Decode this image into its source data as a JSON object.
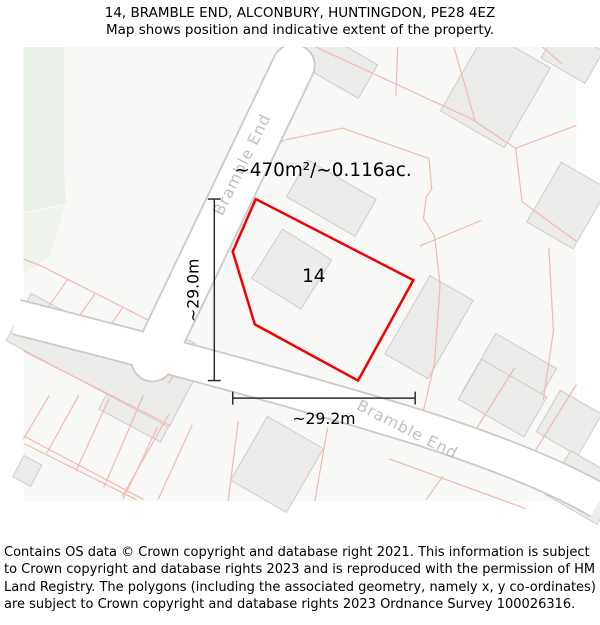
{
  "title": {
    "line1": "14, BRAMBLE END, ALCONBURY, HUNTINGDON, PE28 4EZ",
    "line2": "Map shows position and indicative extent of the property."
  },
  "map": {
    "area_label": "~470m²/~0.116ac.",
    "plot_number": "14",
    "width_label": "~29.2m",
    "height_label": "~29.0m",
    "road_label_top": "Bramble End",
    "road_label_bottom": "Bramble End"
  },
  "footer": {
    "text": "Contains OS data © Crown copyright and database right 2021. This information is subject to Crown copyright and database rights 2023 and is reproduced with the permission of HM Land Registry. The polygons (including the associated geometry, namely x, y co-ordinates) are subject to Crown copyright and database rights 2023 Ordnance Survey 100026316."
  },
  "colors": {
    "map_bg": "#f8f8f6",
    "parcel_line": "#f4b8b0",
    "building_fill": "#ececea",
    "building_stroke": "#c9c9c6",
    "road_fill": "#ffffff",
    "road_casing": "#cbcbc8",
    "road_label": "#c0c0be",
    "green_area": "#eaf1e9",
    "green_area_light": "#eef3ec",
    "property_outline": "#f20000",
    "dimension_line": "#2b2b2b",
    "text": "#000000"
  }
}
